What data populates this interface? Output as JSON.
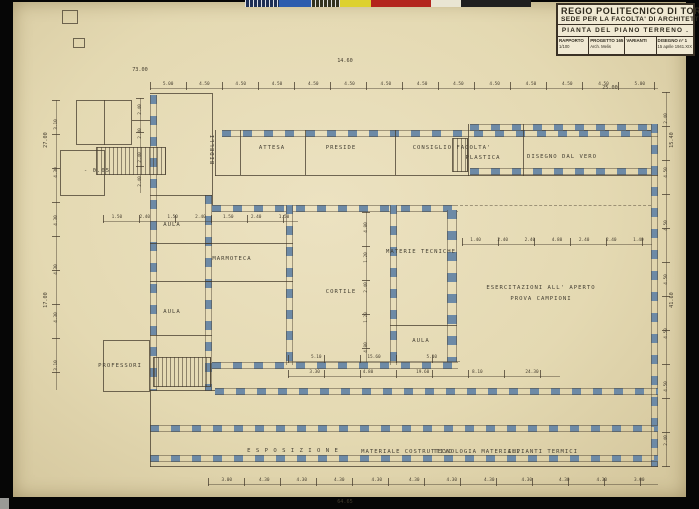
{
  "title_block": {
    "line1": "REGIO POLITECNICO DI TORINO",
    "line2": "SEDE PER LA FACOLTA' DI ARCHITETTURA.",
    "line3": "PIANTA DEL PIANO TERRENO .",
    "cells": [
      {
        "label": "RAPPORTO",
        "value": "1/100"
      },
      {
        "label": "PROGETTO 165",
        "value": "Arch. Melis"
      },
      {
        "label": "VARIANTI",
        "value": ""
      },
      {
        "label": "DISEGNO n° 1",
        "value": "15 aprile 1941.XIX"
      }
    ]
  },
  "color_bar": {
    "segments": [
      {
        "name": "navy-ruler",
        "color": "#1e2f55",
        "w": 34,
        "ticks": true
      },
      {
        "name": "blue",
        "color": "#2c5cae",
        "w": 32
      },
      {
        "name": "olive-ruler",
        "color": "#33331f",
        "w": 29,
        "ticks": true
      },
      {
        "name": "yellow",
        "color": "#ddd12f",
        "w": 31
      },
      {
        "name": "red",
        "color": "#b3251d",
        "w": 60
      },
      {
        "name": "cream",
        "color": "#e9e5d3",
        "w": 30
      },
      {
        "name": "black",
        "color": "#1f1f1f",
        "w": 70
      }
    ]
  },
  "plan_labels": [
    {
      "label": "ATTESA",
      "x": 272,
      "y": 148
    },
    {
      "label": "PRESIDE",
      "x": 341,
      "y": 148
    },
    {
      "label": "CONSIGLIO  FACOLTA'",
      "x": 452,
      "y": 148
    },
    {
      "label": "PLASTICA",
      "x": 483,
      "y": 158
    },
    {
      "label": "DISEGNO  DAL  VERO",
      "x": 562,
      "y": 157
    },
    {
      "label": "AULA",
      "x": 172,
      "y": 225
    },
    {
      "label": "MARMOTECA",
      "x": 232,
      "y": 259
    },
    {
      "label": "AULA",
      "x": 172,
      "y": 312
    },
    {
      "label": "CORTILE",
      "x": 341,
      "y": 292
    },
    {
      "label": "MATERIE  TECNICHE",
      "x": 421,
      "y": 252
    },
    {
      "label": "ESERCITAZIONI  ALL' APERTO",
      "x": 541,
      "y": 288
    },
    {
      "label": "PROVA  CAMPIONI",
      "x": 541,
      "y": 299
    },
    {
      "label": "AULA",
      "x": 421,
      "y": 341
    },
    {
      "label": "PROFESSORI",
      "x": 120,
      "y": 366
    },
    {
      "label": "E S P O S I Z I O N E",
      "x": 293,
      "y": 451
    },
    {
      "label": "MATERIALE  COSTRUTTIVO",
      "x": 407,
      "y": 452
    },
    {
      "label": "TECNOLOGIA  MATERIALI",
      "x": 477,
      "y": 452
    },
    {
      "label": "IMPIANTI  TERMICI",
      "x": 543,
      "y": 452
    },
    {
      "label": "BIDELLI",
      "x": 213,
      "y": 149,
      "vertical": true
    },
    {
      "label": "- 0.05",
      "x": 97,
      "y": 171
    }
  ],
  "dimensions": {
    "strips": [
      {
        "id": "top-bays",
        "dir": "h",
        "x": 150,
        "y": 82,
        "w": 508,
        "values": [
          "5.00",
          "4.50",
          "4.50",
          "4.50",
          "4.50",
          "4.50",
          "4.50",
          "4.50",
          "4.50",
          "4.50",
          "4.50",
          "4.50",
          "4.50",
          "5.00"
        ]
      },
      {
        "id": "bottom-bays",
        "dir": "h",
        "x": 208,
        "y": 478,
        "w": 450,
        "values": [
          "3.00",
          "4.30",
          "4.30",
          "4.30",
          "4.30",
          "4.30",
          "4.30",
          "4.30",
          "4.30",
          "4.30",
          "4.30",
          "3.00"
        ]
      },
      {
        "id": "left-outer",
        "dir": "v",
        "x": 52,
        "y": 100,
        "h": 290,
        "values": [
          "3.10",
          "4.30",
          "4.30",
          "4.30",
          "4.30",
          "3.10"
        ]
      },
      {
        "id": "left-inner",
        "dir": "v",
        "x": 136,
        "y": 98,
        "h": 95,
        "values": [
          "2.40",
          "2.40",
          "2.40",
          "2.40"
        ]
      },
      {
        "id": "right-outer",
        "dir": "v",
        "x": 662,
        "y": 92,
        "h": 375,
        "values": [
          "2.40",
          "4.50",
          "4.50",
          "4.50",
          "4.50",
          "4.50",
          "2.40"
        ]
      },
      {
        "id": "inner-left-wing",
        "dir": "h",
        "x": 103,
        "y": 215,
        "w": 195,
        "values": [
          "1.50",
          "2.40",
          "1.50",
          "2.40",
          "1.50",
          "2.40",
          "1.50"
        ]
      },
      {
        "id": "inner-courtyard",
        "dir": "v",
        "x": 362,
        "y": 212,
        "h": 150,
        "values": [
          "4.80",
          "1.20",
          "2.40",
          "1.20",
          "4.80"
        ]
      },
      {
        "id": "inner-lower",
        "dir": "h",
        "x": 288,
        "y": 370,
        "w": 272,
        "values": [
          "3.30",
          "4.80",
          "19.60",
          "8.10",
          "24.30"
        ]
      },
      {
        "id": "inner-right",
        "dir": "h",
        "x": 462,
        "y": 238,
        "w": 190,
        "values": [
          "1.40",
          "2.40",
          "2.40",
          "4.80",
          "2.40",
          "2.40",
          "1.40"
        ]
      },
      {
        "id": "inner-aula",
        "dir": "h",
        "x": 288,
        "y": 355,
        "w": 172,
        "values": [
          "5.10",
          "15.60",
          "5.10"
        ]
      }
    ],
    "totals": [
      {
        "text": "73.00",
        "x": 140,
        "y": 70
      },
      {
        "text": "14.60",
        "x": 345,
        "y": 61
      },
      {
        "text": "25.00",
        "x": 610,
        "y": 88
      },
      {
        "text": "64.65",
        "x": 345,
        "y": 502
      },
      {
        "text": "15.40",
        "x": 672,
        "y": 140,
        "rot": true
      },
      {
        "text": "41.60",
        "x": 672,
        "y": 300,
        "rot": true
      },
      {
        "text": "27.00",
        "x": 46,
        "y": 140,
        "rot": true
      },
      {
        "text": "17.00",
        "x": 46,
        "y": 300,
        "rot": true
      }
    ]
  }
}
